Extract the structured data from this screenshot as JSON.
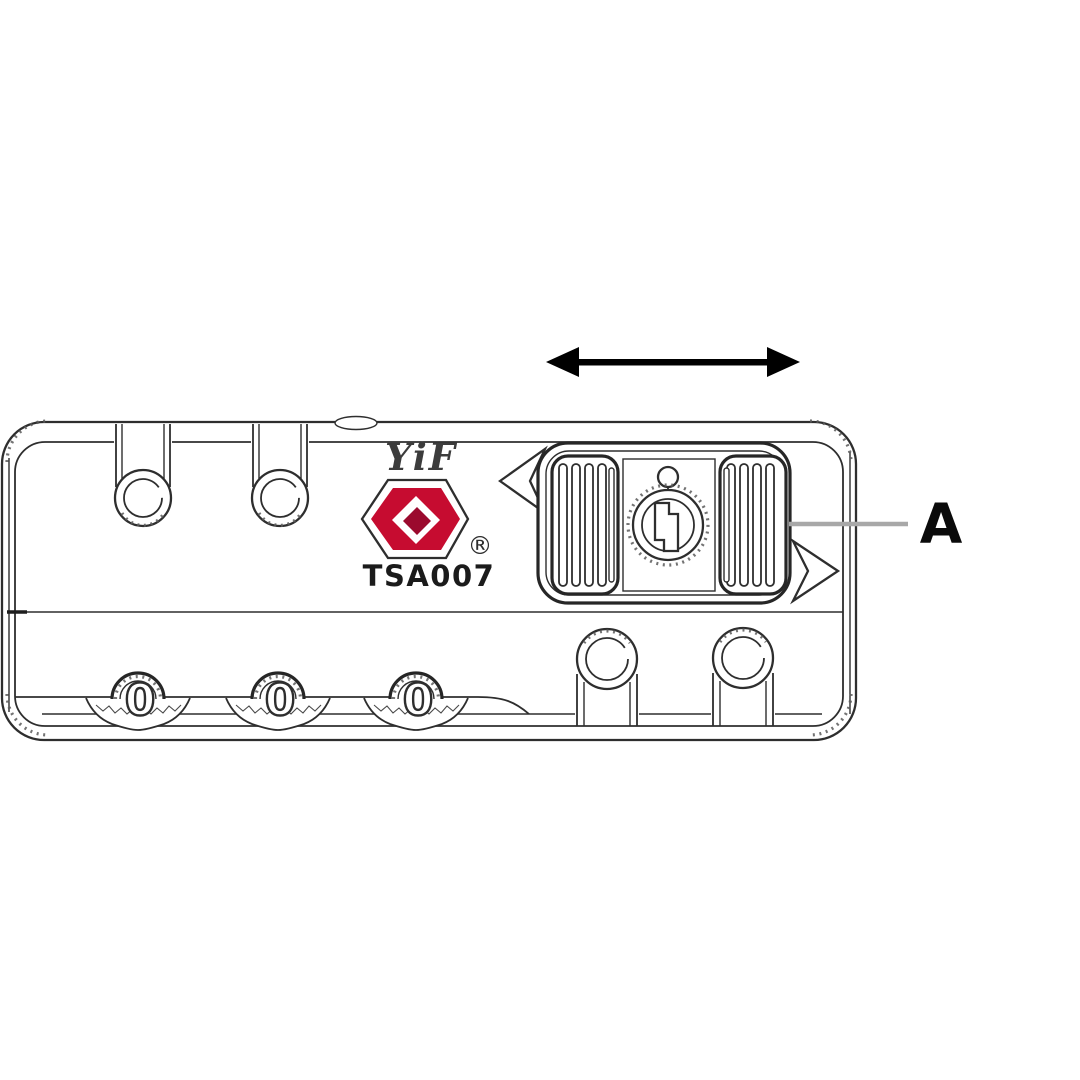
{
  "diagram": {
    "part_label": "A",
    "brand": "YiF",
    "registered_mark": "®",
    "model": "TSA007",
    "dial_digits": [
      "0",
      "0",
      "0"
    ],
    "colors": {
      "logo_red": "#c60c30",
      "logo_red_dark": "#9b0a2e",
      "line": "#2e2e2e",
      "leader_gray": "#a8a8a8",
      "arrow_black": "#000000"
    }
  }
}
